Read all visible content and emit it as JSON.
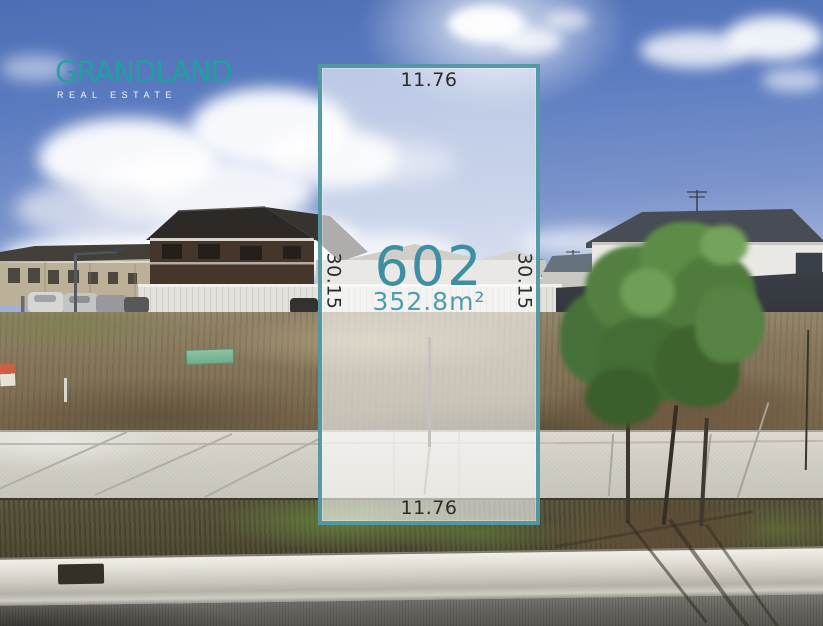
{
  "brand": {
    "name": "GRANDLAND",
    "tagline": "REAL ESTATE"
  },
  "lot_overlay": {
    "lot_number": "602",
    "area": "352.8m²",
    "dimensions": {
      "top": "11.76",
      "bottom": "11.76",
      "left": "30.15",
      "right": "30.15"
    }
  },
  "colors": {
    "brand_teal": "#1fa39d",
    "boundary_teal": "#49949d",
    "lot_number_teal": "#3e8fa2",
    "area_teal": "#4f9dad",
    "dimension_text": "#2b2b2b",
    "sky_blue": "#5d7dc0"
  }
}
